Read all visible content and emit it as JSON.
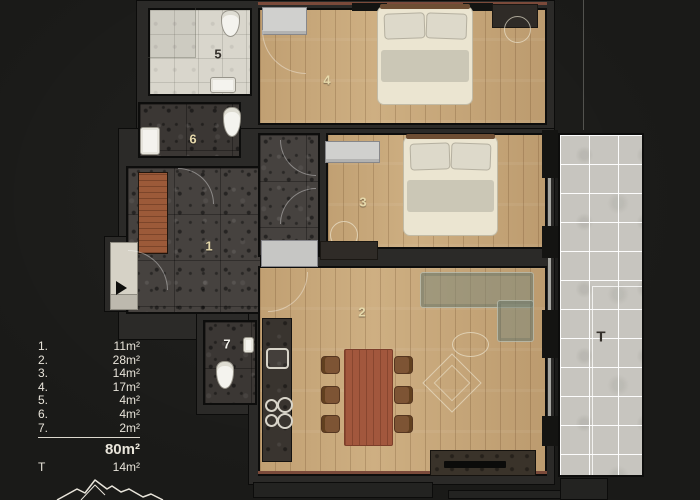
{
  "plan": {
    "room_labels": [
      "1",
      "2",
      "3",
      "4",
      "5",
      "6",
      "7"
    ],
    "terrace_label": "T"
  },
  "legend": {
    "items": [
      {
        "num": "1.",
        "value": "11m²"
      },
      {
        "num": "2.",
        "value": "28m²"
      },
      {
        "num": "3.",
        "value": "14m²"
      },
      {
        "num": "4.",
        "value": "17m²"
      },
      {
        "num": "5.",
        "value": "4m²"
      },
      {
        "num": "6.",
        "value": "4m²"
      },
      {
        "num": "7.",
        "value": "2m²"
      }
    ],
    "total": "80m²",
    "terrace_row": {
      "num": "T",
      "value": "14m²"
    }
  },
  "colors": {
    "background": "#1a1a18",
    "wall": "#2b2a28",
    "wood_floor": "#c9a97b",
    "stone_tile": "#46423f",
    "light_tile": "#d9d6cc",
    "terrace_tile": "#c7c5bf",
    "exterior_accent_line": "#7b4a3a",
    "legend_text": "#e8e4da"
  }
}
